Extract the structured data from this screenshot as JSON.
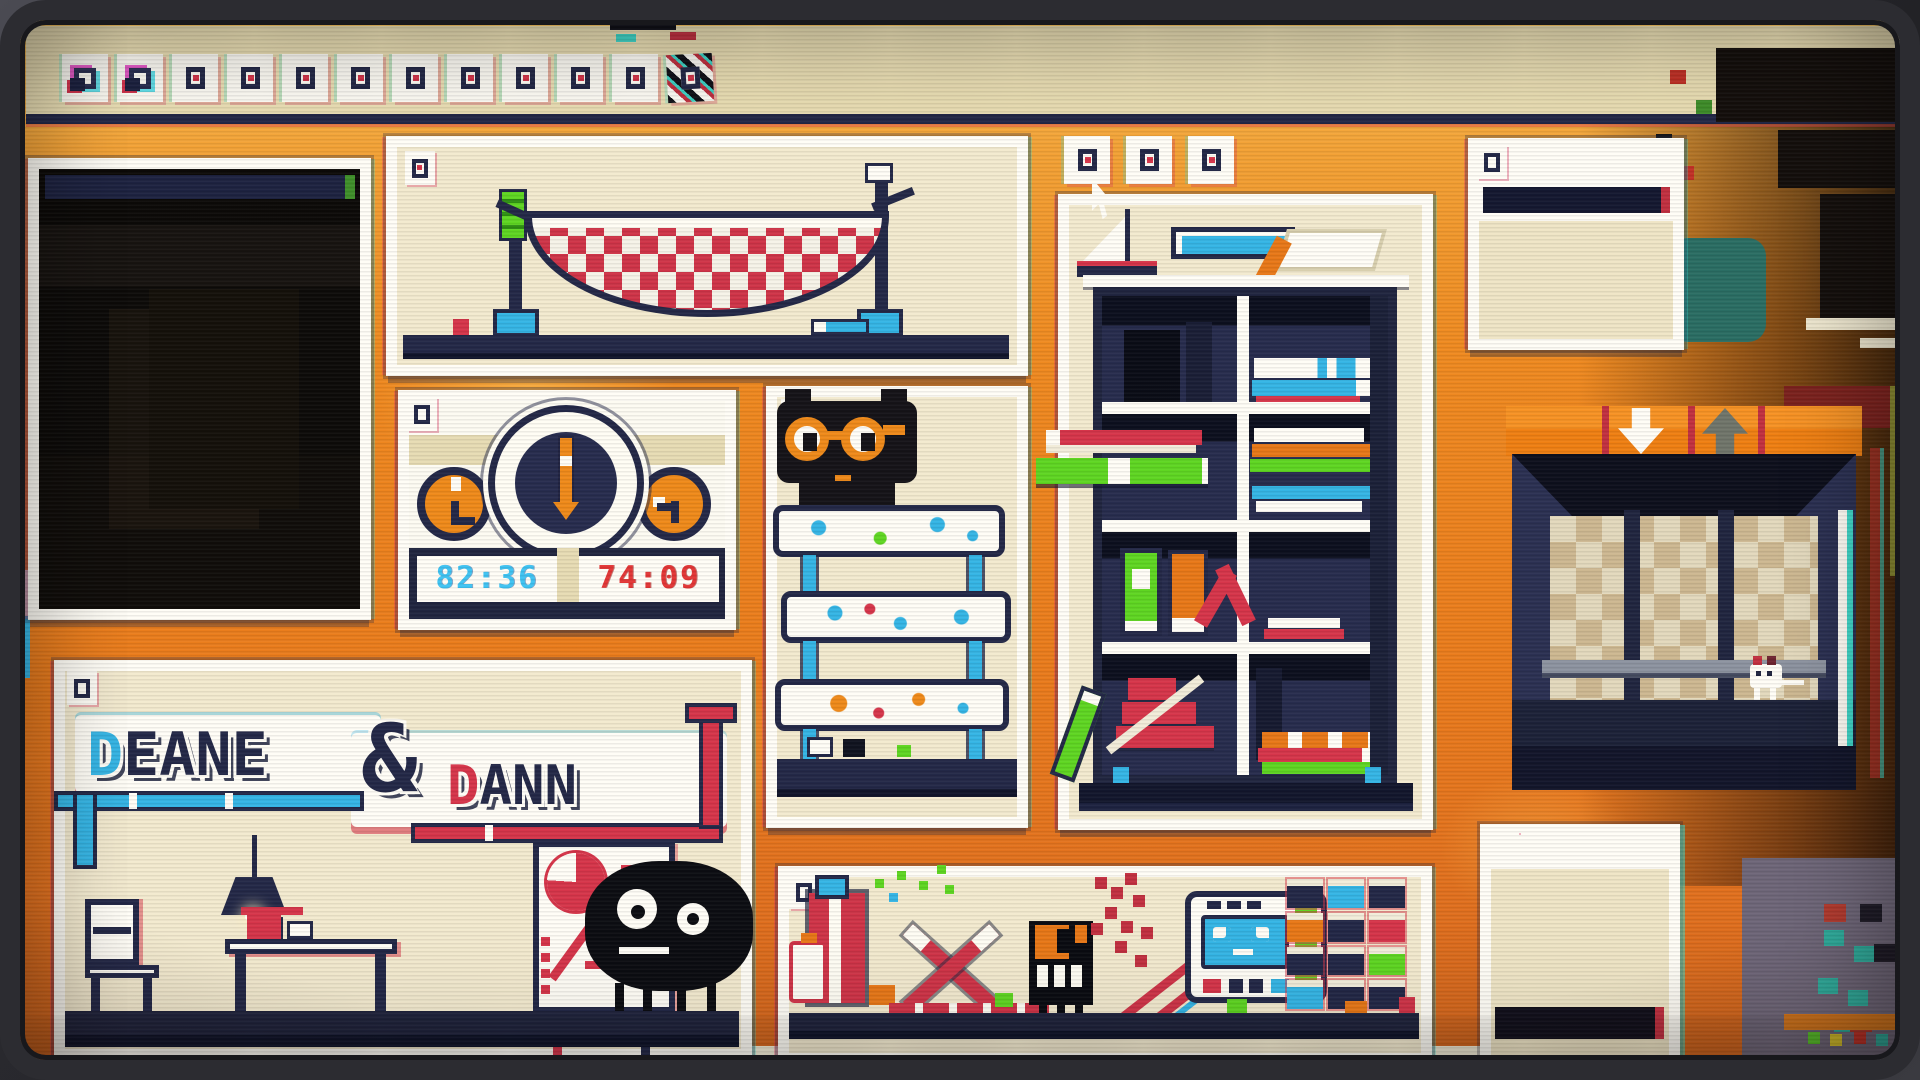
{
  "screen_type": "retro-pixel-room-builder",
  "colors": {
    "wall_orange": "#ee8a21",
    "cream_bar": "#ebdfb4",
    "panel_cream": "#f3eacf",
    "navy": "#232847",
    "cyan": "#35b5e5",
    "red": "#d6354a",
    "green": "#5fd622",
    "orange_accent": "#ef8a1a",
    "digit_blue": "#3fc3f2",
    "digit_red": "#e23636",
    "elevator_orange": "#f07f12",
    "white": "#fffdf6"
  },
  "toolbar": {
    "icons": [
      {
        "name": "photo-stack-icon",
        "selected": false
      },
      {
        "name": "photo-stack-icon",
        "selected": false
      },
      {
        "name": "frame-icon",
        "selected": false
      },
      {
        "name": "frame-icon",
        "selected": false
      },
      {
        "name": "frame-icon",
        "selected": false
      },
      {
        "name": "frame-icon",
        "selected": false
      },
      {
        "name": "frame-icon",
        "selected": false
      },
      {
        "name": "frame-icon",
        "selected": false
      },
      {
        "name": "frame-icon",
        "selected": false
      },
      {
        "name": "frame-icon",
        "selected": false
      },
      {
        "name": "frame-icon",
        "selected": false
      },
      {
        "name": "frame-icon",
        "selected": true,
        "state": "glitched"
      }
    ]
  },
  "panels": {
    "photo_window": {
      "name": "dark-photo-window",
      "title_text": ""
    },
    "hammock": {
      "name": "hammock-window"
    },
    "clocks": {
      "name": "clock-window",
      "display_left": "82:36",
      "display_right": "74:09"
    },
    "cat_shelf": {
      "name": "cat-bunk-window"
    },
    "bookshelf": {
      "name": "bookshelf-window",
      "buttons": [
        "frame",
        "frame",
        "frame"
      ]
    },
    "elevator": {
      "name": "elevator-shaft",
      "buttons": [
        "down",
        "up"
      ]
    },
    "studio": {
      "name": "studio-window",
      "logo": {
        "word1_initial": "D",
        "word1_rest": "EANE",
        "ampersand": "&",
        "word2_initial": "D",
        "word2_rest": "ANN"
      }
    },
    "workshop": {
      "name": "workshop-window"
    },
    "blank_top_right": {
      "name": "blank-window-top-right"
    },
    "blank_bottom_right": {
      "name": "blank-window-bottom-right"
    }
  }
}
